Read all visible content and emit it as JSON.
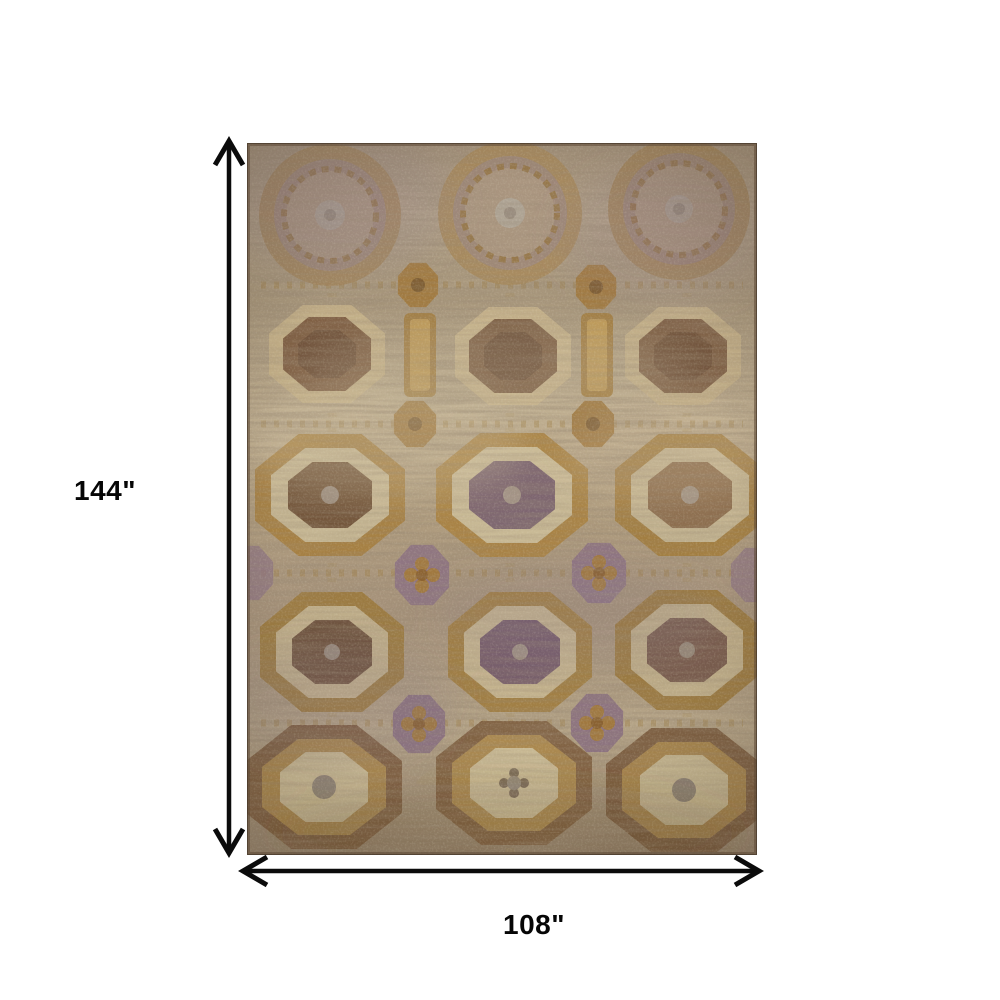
{
  "scene": {
    "type": "product-dimensions-image",
    "background_color": "#ffffff"
  },
  "dimensions": {
    "height": {
      "label": "144\"",
      "orientation": "vertical"
    },
    "width": {
      "label": "108\"",
      "orientation": "horizontal"
    },
    "arrow_color": "#0b0b0b",
    "label_color": "#060606"
  },
  "rug": {
    "style": "distressed vintage medallion area rug",
    "pattern": "grid of octagonal medallions, 3 columns by 5 rows, diamond motifs between rows",
    "palette": {
      "field_tan": "#b3a283",
      "light_cream": "#cdbf9c",
      "gold": "#a5803f",
      "brown": "#74563b",
      "mauve": "#8b7486",
      "dark_edge": "#5c4836"
    }
  }
}
